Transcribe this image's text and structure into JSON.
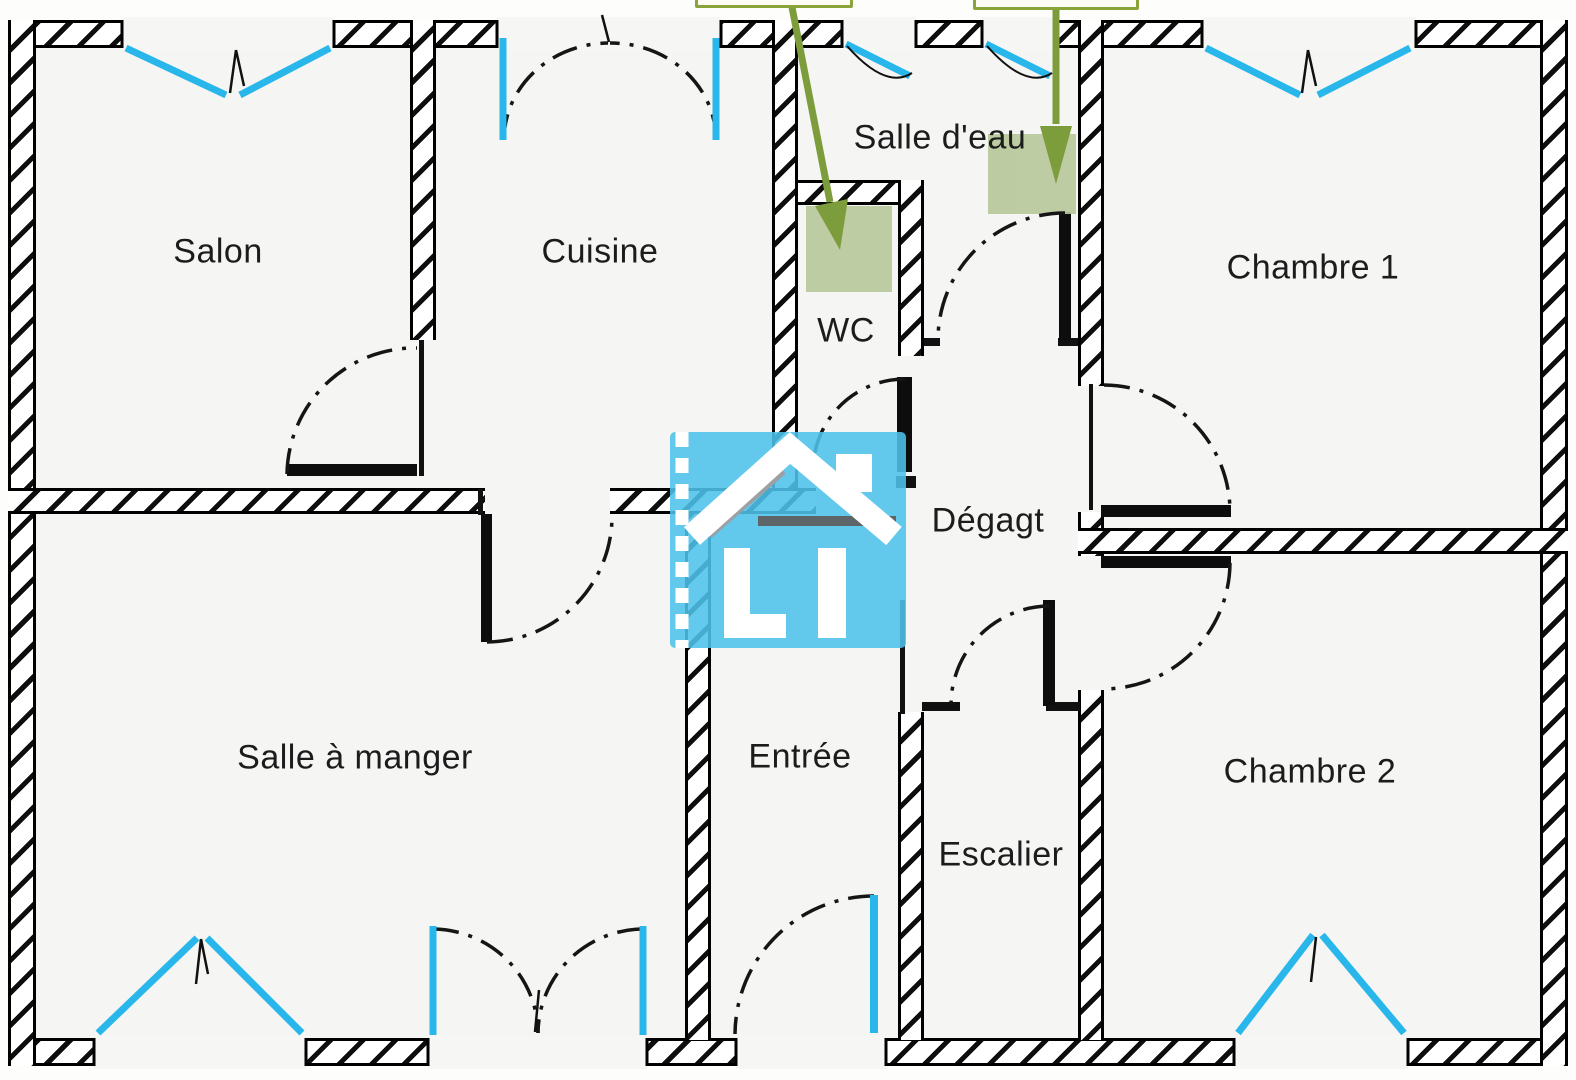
{
  "plan": {
    "rooms": {
      "salon": {
        "label": "Salon"
      },
      "cuisine": {
        "label": "Cuisine"
      },
      "salle_deau": {
        "label": "Salle d'eau"
      },
      "wc": {
        "label": "WC"
      },
      "chambre1": {
        "label": "Chambre 1"
      },
      "degagement": {
        "label": "Dégagt"
      },
      "salle_a_manger": {
        "label": "Salle à manger"
      },
      "entree": {
        "label": "Entrée"
      },
      "escalier": {
        "label": "Escalier"
      },
      "chambre2": {
        "label": "Chambre 2"
      }
    },
    "annotations": {
      "callout_count": 2,
      "target_square_count": 2,
      "arrow_color": "#7d9d3c",
      "target_fill": "#b9c89c",
      "callout_border": "#8aa43a"
    },
    "colors": {
      "window_glazing": "#29b7eb",
      "wall_line": "#111111",
      "room_fill": "#f5f5f4",
      "watermark_blue": "#54c2ec"
    }
  }
}
